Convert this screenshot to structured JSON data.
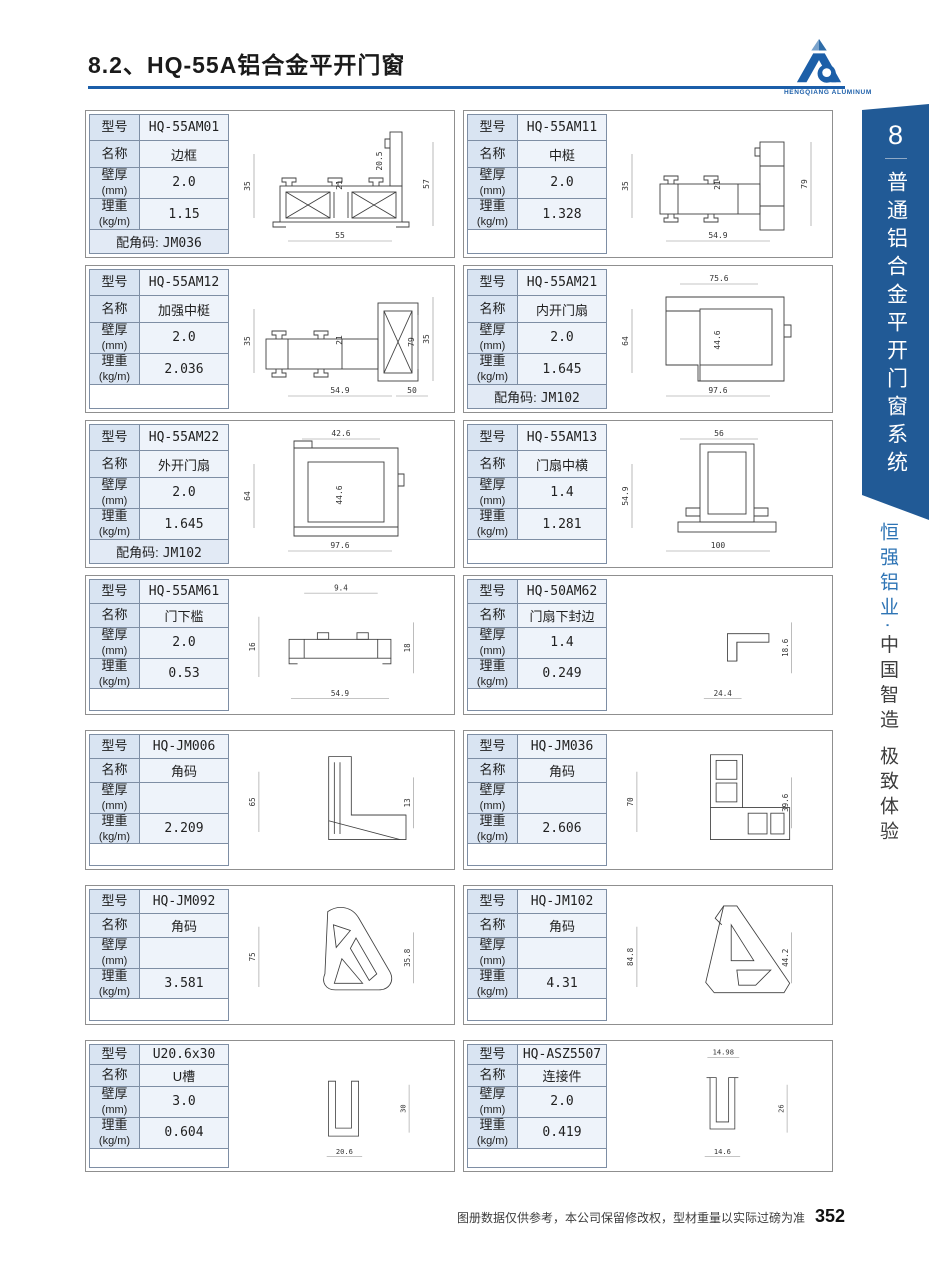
{
  "page": {
    "title": "8.2、HQ-55A铝合金平开门窗",
    "footer_note": "图册数据仅供参考，本公司保留修改权，型材重量以实际过磅为准",
    "page_number": "352"
  },
  "logo": {
    "text": "HENGQIANG ALUMINUM"
  },
  "sidebar": {
    "chapter_number": "8",
    "chapter_title": "普通铝合金平开门窗系统",
    "brand": "恒强铝业",
    "separator": "·",
    "slogan": "中国智造 极致体验"
  },
  "labels": {
    "model": "型号",
    "name": "名称",
    "thickness": "壁厚",
    "thickness_unit": "(mm)",
    "weight": "理重",
    "weight_unit": "(kg/m)",
    "corner_prefix": "配角码:"
  },
  "cards": [
    {
      "model": "HQ-55AM01",
      "name": "边框",
      "thickness": "2.0",
      "weight": "1.15",
      "corner_code": "JM036",
      "shape": "frame",
      "dims": [
        {
          "v": "55",
          "slot": "bottom"
        },
        {
          "v": "35",
          "slot": "left"
        },
        {
          "v": "21",
          "slot": "inner"
        },
        {
          "v": "20.5",
          "slot": "innerRight"
        },
        {
          "v": "57",
          "slot": "right"
        }
      ]
    },
    {
      "model": "HQ-55AM11",
      "name": "中梃",
      "thickness": "2.0",
      "weight": "1.328",
      "shape": "mullion",
      "dims": [
        {
          "v": "54.9",
          "slot": "bottom"
        },
        {
          "v": "35",
          "slot": "left"
        },
        {
          "v": "21",
          "slot": "inner"
        },
        {
          "v": "79",
          "slot": "right"
        }
      ]
    },
    {
      "model": "HQ-55AM12",
      "name": "加强中梃",
      "thickness": "2.0",
      "weight": "2.036",
      "shape": "reinforced",
      "dims": [
        {
          "v": "54.9",
          "slot": "bottom"
        },
        {
          "v": "50",
          "slot": "bottom2"
        },
        {
          "v": "35",
          "slot": "left"
        },
        {
          "v": "21",
          "slot": "inner"
        },
        {
          "v": "79",
          "slot": "right2"
        },
        {
          "v": "35",
          "slot": "right"
        }
      ]
    },
    {
      "model": "HQ-55AM21",
      "name": "内开门扇",
      "thickness": "2.0",
      "weight": "1.645",
      "corner_code": "JM102",
      "shape": "sash_in",
      "dims": [
        {
          "v": "75.6",
          "slot": "top"
        },
        {
          "v": "44.6",
          "slot": "inner"
        },
        {
          "v": "64",
          "slot": "left"
        },
        {
          "v": "97.6",
          "slot": "bottom"
        }
      ]
    },
    {
      "model": "HQ-55AM22",
      "name": "外开门扇",
      "thickness": "2.0",
      "weight": "1.645",
      "corner_code": "JM102",
      "shape": "sash_out",
      "dims": [
        {
          "v": "42.6",
          "slot": "top"
        },
        {
          "v": "64",
          "slot": "left"
        },
        {
          "v": "44.6",
          "slot": "inner"
        },
        {
          "v": "97.6",
          "slot": "bottom"
        }
      ]
    },
    {
      "model": "HQ-55AM13",
      "name": "门扇中横",
      "thickness": "1.4",
      "weight": "1.281",
      "shape": "sash_mid",
      "dims": [
        {
          "v": "56",
          "slot": "top"
        },
        {
          "v": "54.9",
          "slot": "left"
        },
        {
          "v": "100",
          "slot": "bottom"
        }
      ]
    },
    {
      "model": "HQ-55AM61",
      "name": "门下槛",
      "thickness": "2.0",
      "weight": "0.53",
      "shape": "sill",
      "dims": [
        {
          "v": "9.4",
          "slot": "top"
        },
        {
          "v": "16",
          "slot": "left"
        },
        {
          "v": "18",
          "slot": "right2"
        },
        {
          "v": "54.9",
          "slot": "bottom"
        }
      ]
    },
    {
      "model": "HQ-50AM62",
      "name": "门扇下封边",
      "thickness": "1.4",
      "weight": "0.249",
      "shape": "seal",
      "dims": [
        {
          "v": "24.4",
          "slot": "bottomSmall"
        },
        {
          "v": "18.6",
          "slot": "right2"
        }
      ]
    },
    {
      "model": "HQ-JM006",
      "name": "角码",
      "thickness": "",
      "weight": "2.209",
      "shape": "corner_l1",
      "dims": [
        {
          "v": "65",
          "slot": "left"
        },
        {
          "v": "13",
          "slot": "right2"
        }
      ]
    },
    {
      "model": "HQ-JM036",
      "name": "角码",
      "thickness": "",
      "weight": "2.606",
      "shape": "corner_l2",
      "dims": [
        {
          "v": "70",
          "slot": "left"
        },
        {
          "v": "39.6",
          "slot": "right2"
        }
      ]
    },
    {
      "model": "HQ-JM092",
      "name": "角码",
      "thickness": "",
      "weight": "3.581",
      "shape": "corner_t1",
      "dims": [
        {
          "v": "75",
          "slot": "left"
        },
        {
          "v": "35.8",
          "slot": "right2"
        }
      ]
    },
    {
      "model": "HQ-JM102",
      "name": "角码",
      "thickness": "",
      "weight": "4.31",
      "shape": "corner_t2",
      "dims": [
        {
          "v": "84.8",
          "slot": "left"
        },
        {
          "v": "44.2",
          "slot": "right2"
        }
      ]
    },
    {
      "model": "U20.6x30",
      "name": "U槽",
      "thickness": "3.0",
      "weight": "0.604",
      "shape": "u_channel",
      "dims": [
        {
          "v": "30",
          "slot": "right2"
        },
        {
          "v": "20.6",
          "slot": "bottomSmall"
        }
      ]
    },
    {
      "model": "HQ-ASZ5507",
      "name": "连接件",
      "thickness": "2.0",
      "weight": "0.419",
      "shape": "connector",
      "dims": [
        {
          "v": "14.98",
          "slot": "topSmall"
        },
        {
          "v": "26",
          "slot": "right2"
        },
        {
          "v": "14.6",
          "slot": "bottomSmall"
        }
      ]
    }
  ],
  "colors": {
    "accent_blue": "#1b5ea9",
    "ribbon_blue": "#215a96",
    "brand_blue": "#2e74b5",
    "table_label_bg": "#d9e4f2",
    "table_value_bg": "#eef3fa",
    "table_border": "#7e8ea4",
    "card_border": "#8f8f8f"
  }
}
